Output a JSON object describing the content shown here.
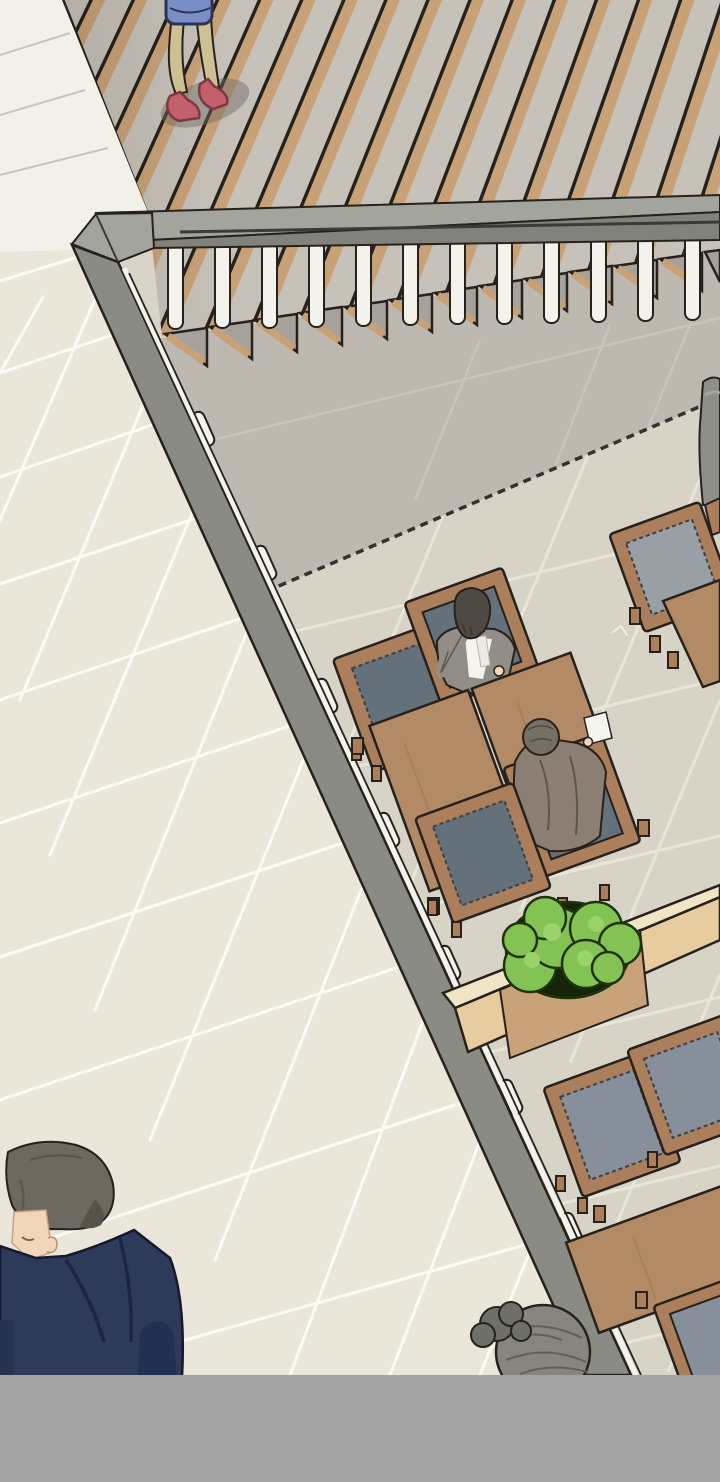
{
  "scene": {
    "panel_type": "webtoon-illustration-panel",
    "description": "High-angle isometric view of a cafe terrace: a wooden deck walkway with a walking woman at top, a gray railing with white balusters running along two edges, a cream tiled outdoor walkway on the left, and an interior seating area with wooden tables, cushioned chairs, a planter with green bushes, a seated man in a gray suit, a seated man in a brown jacket, a man in a navy suit at bottom left, and a woman with a hair bun at bottom center. A flat gray letterbox bar spans the bottom."
  },
  "labels": {
    "deck": "wooden deck walkway",
    "walking_woman": "woman walking with blue bag and red heels",
    "railing": "gray terrace railing with white balusters",
    "outdoor_floor": "cream tiled outdoor walkway",
    "cafe_floor": "interior cafe floor with shadowed area",
    "table_set_middle": "middle table with two seated men",
    "suit_man": "seated man in gray suit and tie",
    "jacket_man": "seated man in brown jacket holding paper",
    "table_set_upper": "upper-right chair and table",
    "table_set_lower": "lower-right chairs and table",
    "planter": "wooden planter box with green bushes",
    "standing_figure": "partial standing figure at right edge",
    "navy_man": "man in navy suit at bottom left",
    "bun_woman": "woman with gray hair bun",
    "letterbox": "gray panel bar"
  },
  "palette": {
    "ink": "#27211c",
    "deckBase": "#c6c2b9",
    "deckWood": "#c9a177",
    "toothShadow": "#a6a29b",
    "plankBand": "#f3f0e9",
    "plankLine": "#c9c5bc",
    "railTop": "#a4a49e",
    "railFace": "#82827c",
    "railSeam": "#3a3a36",
    "railBand": "#8b8b85",
    "balusterWhite": "#f4f2ec",
    "outerTile": "#eae6da",
    "outerGrout": "#fbfaf5",
    "interiorTile": "#d7d3c7",
    "interiorGrout": "#e8e5d9",
    "shadowTile": "#bdb9b0",
    "shadowGrout": "#c9c5bc",
    "dashLine": "#35312c",
    "tableWood": "#b28a66",
    "tableWoodEdge": "#8a684c",
    "chairWood": "#ab7f5b",
    "cushionDark": "#64707a",
    "cushionLight": "#98a0a6",
    "cushionMid": "#87909a",
    "stitch": "#39424a",
    "planterTop": "#f1e5c7",
    "planterFace": "#e7cc9f",
    "planterMid": "#c9a279",
    "bushGreen": "#82c353",
    "bushHighlight": "#9ad369",
    "bushOutline": "#20330e",
    "bushGap": "#15240b",
    "suitGray": "#928e87",
    "shirtWhite": "#f6f4ef",
    "tieWhite": "#eceae3",
    "hairSuitMan": "#4e4942",
    "skin": "#f2d6ba",
    "hairJacketMan": "#756f66",
    "jacketBrown": "#8b7e72",
    "navy": "#2d3a59",
    "navyDark": "#1b2442",
    "hairNavyMan": "#6d6960",
    "hairBun": "#86867f",
    "bunBlob": "#6f6f69",
    "bunDark": "#60605a",
    "legTan": "#cdc092",
    "shoeRed": "#c2606c",
    "sockYellow": "#e9e2a4",
    "bagBlue": "#7a8ec6",
    "bagOutline": "#2c3456",
    "barGray": "#a3a3a3",
    "standFigure": "#8f8f89",
    "scuff": "#f2efe5",
    "groundShadow": "#6f6b62"
  }
}
